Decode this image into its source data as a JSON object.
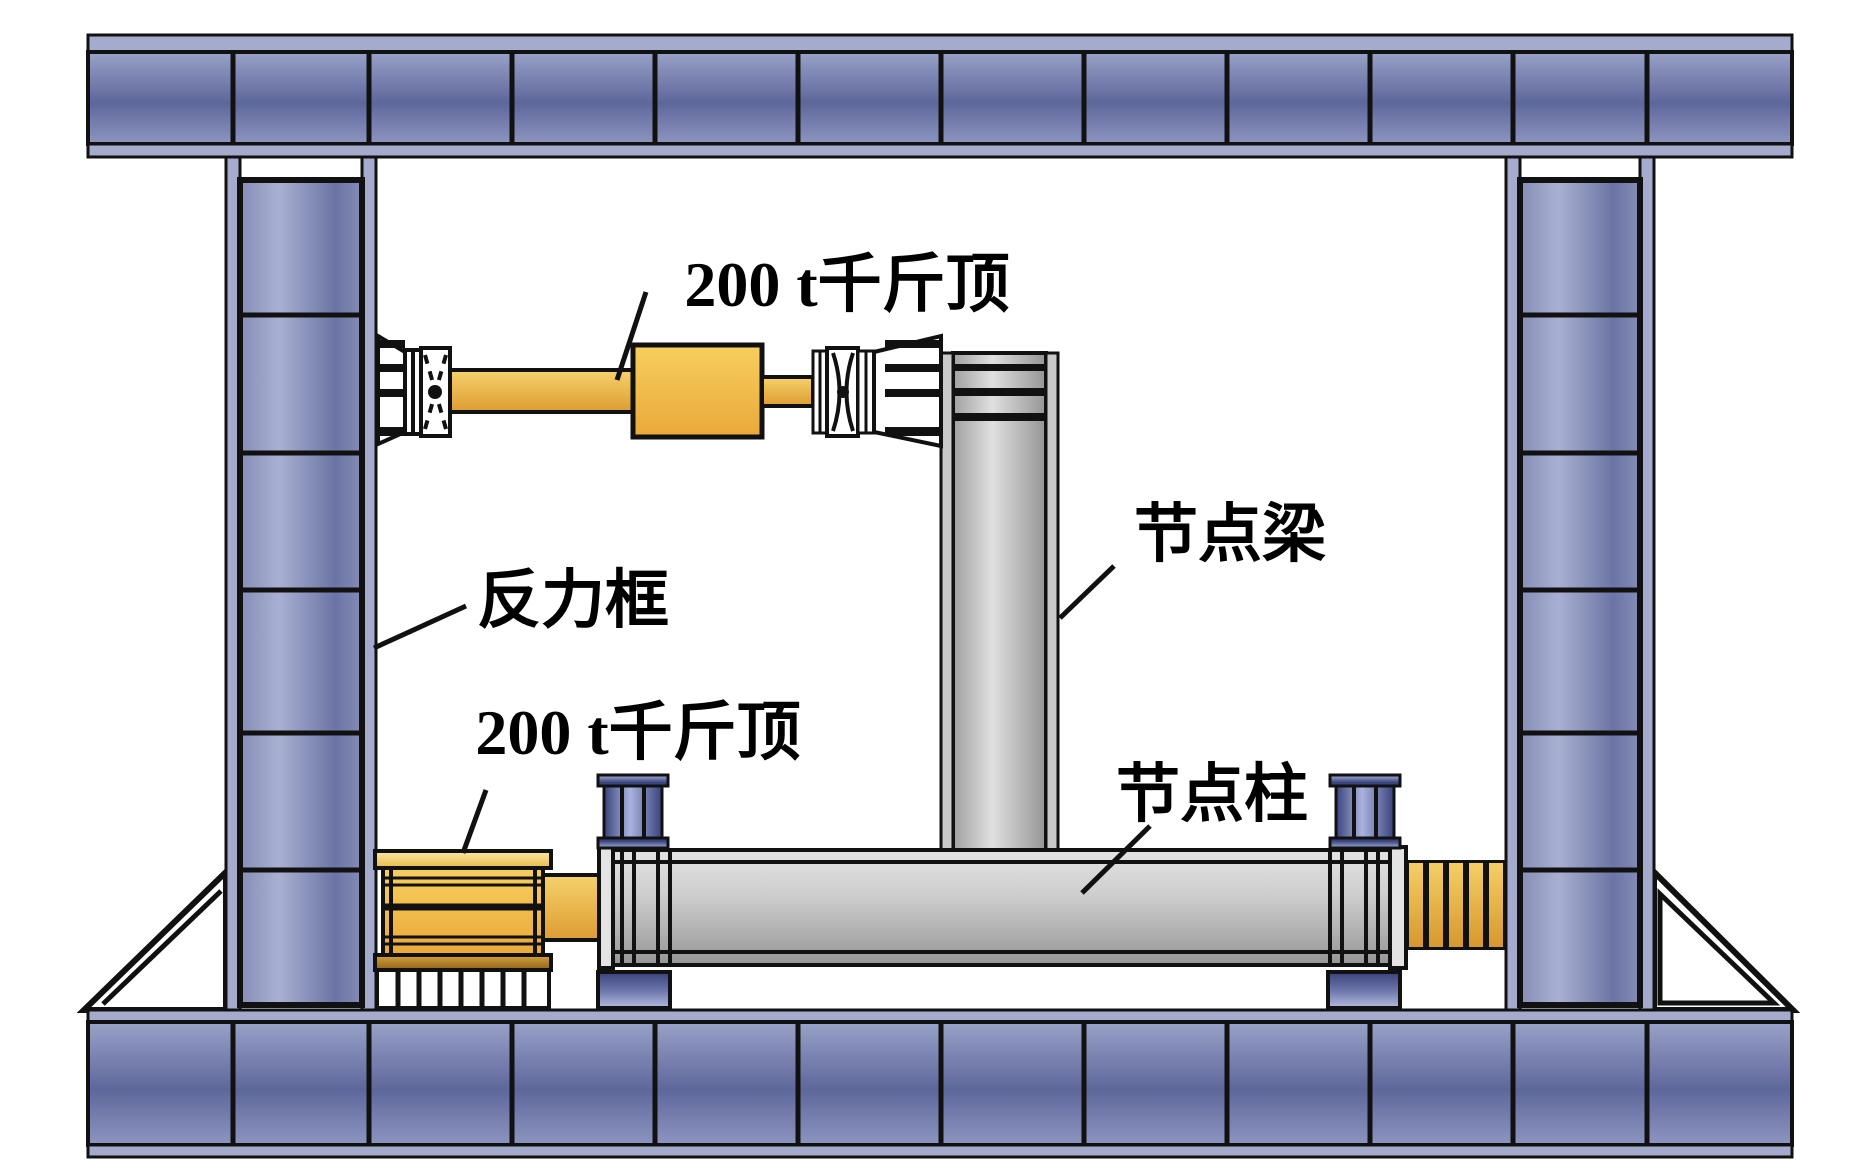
{
  "diagram": {
    "title_hint": "structural joint test setup schematic",
    "labels": {
      "jack_top": "200 t千斤顶",
      "reaction_frame": "反力框",
      "jack_bottom": "200 t千斤顶",
      "joint_beam": "节点梁",
      "joint_column": "节点柱"
    },
    "colors": {
      "frame_blue_light": "#a4abcc",
      "frame_blue_mid": "#848db6",
      "frame_blue_dark": "#5e679a",
      "jack_yellow_light": "#f6d068",
      "jack_yellow_dark": "#e0a136",
      "specimen_gray_light": "#e2e2e2",
      "specimen_gray_dark": "#989898",
      "support_blue_dark": "#39437c",
      "support_blue_light": "#aab3dd",
      "outline_black": "#111111",
      "background": "#ffffff"
    }
  }
}
